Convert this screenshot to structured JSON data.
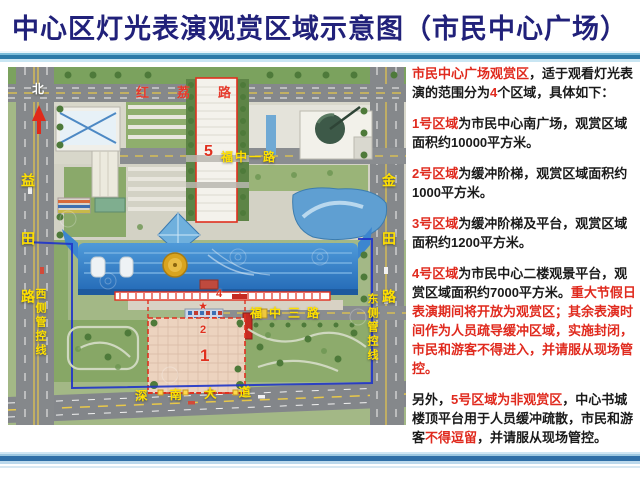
{
  "title": "中心区灯光表演观赏区域示意图（市民中心广场）",
  "colors": {
    "title_navy": "#21217a",
    "alert_red": "#e02a1e",
    "road_label_yellow": "#ffe000",
    "civic_roof_blue": "#2b7ecb",
    "boundary_blue": "#2236c8"
  },
  "map": {
    "north_label": "北",
    "star_icon": "★",
    "roads": {
      "top": "红荔路",
      "left": "益田路",
      "right": "金田路",
      "mid_upper": "福中一路",
      "mid_lower": "福中三路",
      "bottom": "深南大道"
    },
    "control_lines": {
      "west": "西侧管控线",
      "east": "东侧管控线"
    },
    "zones": {
      "z1": "1",
      "z2": "2",
      "z4": "4",
      "z5": "5"
    }
  },
  "panel": {
    "paragraphs": [
      {
        "id": "intro",
        "segments": [
          {
            "text": "市民中心广场观赏区",
            "style": "red"
          },
          {
            "text": "，适于观看灯光表演的范围分为",
            "style": "black"
          },
          {
            "text": "4",
            "style": "red"
          },
          {
            "text": "个区域，具体如下：",
            "style": "black"
          }
        ]
      },
      {
        "id": "zone1",
        "segments": [
          {
            "text": "1号区域",
            "style": "red"
          },
          {
            "text": "为市民中心南广场，观赏区域面积约10000平方米。",
            "style": "black"
          }
        ]
      },
      {
        "id": "zone2",
        "segments": [
          {
            "text": "2号区域",
            "style": "red"
          },
          {
            "text": "为缓冲阶梯，观赏区域面积约1000平方米。",
            "style": "black"
          }
        ]
      },
      {
        "id": "zone3",
        "segments": [
          {
            "text": "3号区域",
            "style": "red"
          },
          {
            "text": "为缓冲阶梯及平台，观赏区域面积约1200平方米。",
            "style": "black"
          }
        ]
      },
      {
        "id": "zone4",
        "segments": [
          {
            "text": "4号区域",
            "style": "red"
          },
          {
            "text": "为市民中心二楼观景平台，观赏区域面积约7000平方米。",
            "style": "black"
          },
          {
            "text": "重大节假日表演期间将开放为观赏区；其余表演时间作为人员疏导缓冲区域，实施封闭，市民和游客不得进入，并请服从现场管控。",
            "style": "red"
          }
        ]
      },
      {
        "id": "zone5",
        "segments": [
          {
            "text": "另外，",
            "style": "black"
          },
          {
            "text": "5号区域为非观赏区",
            "style": "red"
          },
          {
            "text": "，中心书城楼顶平台用于人员缓冲疏散，市民和游客",
            "style": "black"
          },
          {
            "text": "不得逗留",
            "style": "red"
          },
          {
            "text": "，并请服从现场管控。",
            "style": "black"
          }
        ]
      }
    ]
  }
}
